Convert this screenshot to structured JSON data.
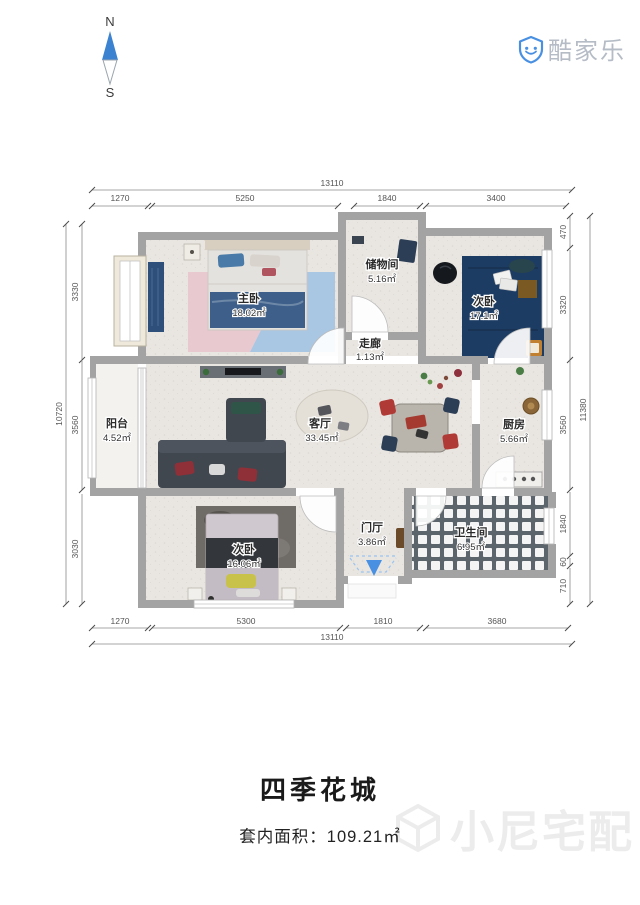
{
  "compass": {
    "north": "N",
    "south": "S"
  },
  "logo": {
    "name": "酷家乐"
  },
  "plan": {
    "rooms": [
      {
        "id": "master-bedroom",
        "name": "主卧",
        "area": "18.02㎡"
      },
      {
        "id": "storage-room",
        "name": "储物间",
        "area": "5.16㎡"
      },
      {
        "id": "bedroom-2",
        "name": "次卧",
        "area": "17.1㎡"
      },
      {
        "id": "corridor",
        "name": "走廊",
        "area": "1.13㎡"
      },
      {
        "id": "balcony",
        "name": "阳台",
        "area": "4.52㎡"
      },
      {
        "id": "living-room",
        "name": "客厅",
        "area": "33.45㎡"
      },
      {
        "id": "kitchen",
        "name": "厨房",
        "area": "5.66㎡"
      },
      {
        "id": "bedroom-3",
        "name": "次卧",
        "area": "16.06㎡"
      },
      {
        "id": "entrance-hall",
        "name": "门厅",
        "area": "3.86㎡"
      },
      {
        "id": "bathroom",
        "name": "卫生间",
        "area": "6.95㎡"
      }
    ],
    "dimensions": {
      "top": {
        "total": "13110",
        "segments": [
          "1270",
          "5250",
          "1840",
          "3400"
        ]
      },
      "bottom": {
        "total": "13110",
        "segments": [
          "1270",
          "5300",
          "1810",
          "3680"
        ]
      },
      "left": {
        "total": "10720",
        "segments": [
          "3330",
          "3560",
          "3030"
        ]
      },
      "right": {
        "total": "11380",
        "segments": [
          "470",
          "3320",
          "3560",
          "1840",
          "60",
          "710"
        ]
      }
    }
  },
  "footer": {
    "title": "四季花城",
    "area_label": "套内面积：",
    "area_value": "109.21㎡"
  },
  "watermark": {
    "text": "小尼宅配"
  },
  "colors": {
    "brand_blue": "#4a90e2",
    "compass_blue": "#3b82d0",
    "wall": "#a3a3a3",
    "dim_text": "#555555",
    "logo_text": "#b5bcc6",
    "watermark": "#ececec",
    "rug_master_pink": "#e7c9cf",
    "rug_master_blue": "#a9c6e2",
    "rug_bedroom2": "#1d3c63",
    "sofa_dark": "#41474f",
    "bathroom_tile_bg": "#5d656c"
  }
}
